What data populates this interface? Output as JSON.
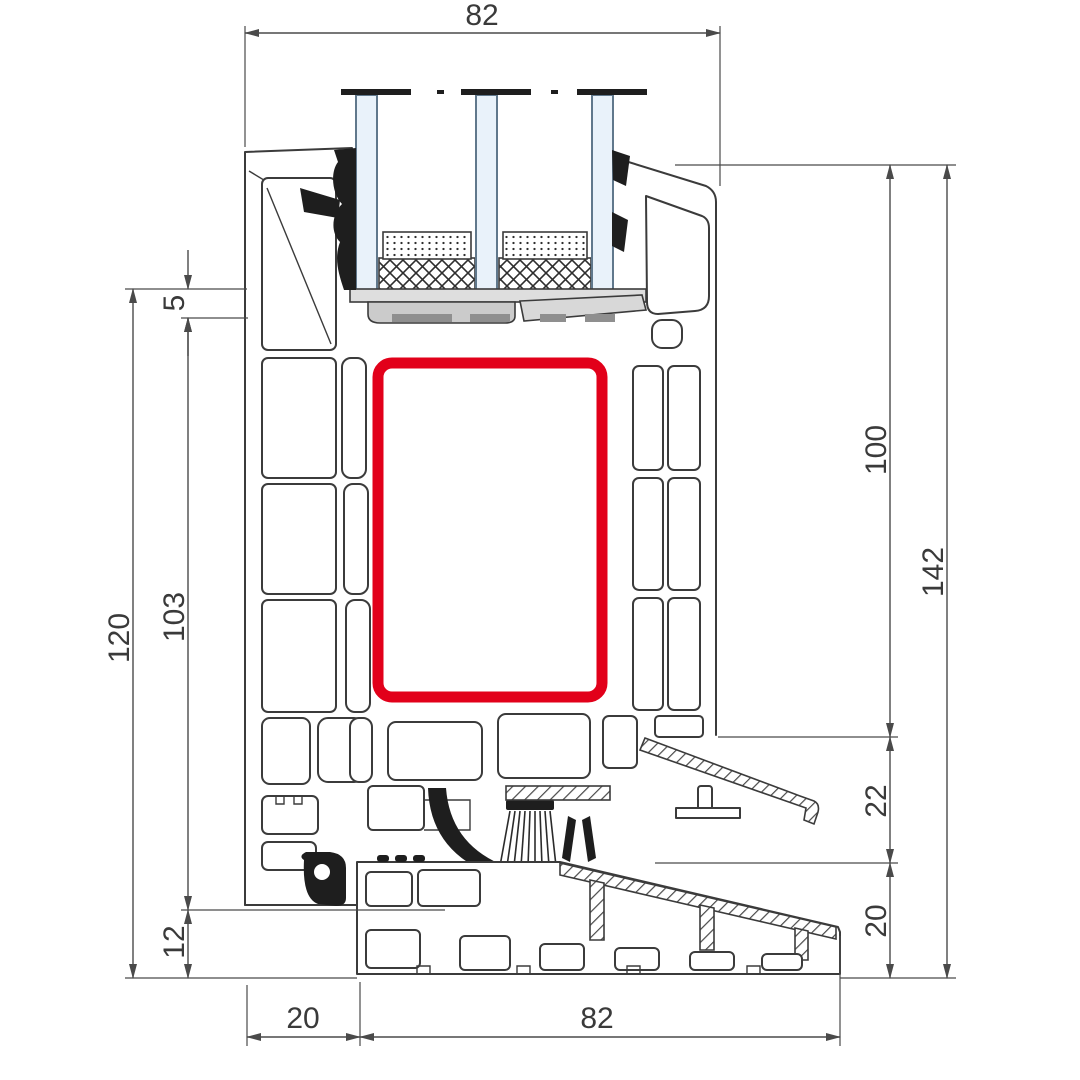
{
  "diagram": {
    "type": "technical-cross-section",
    "subject": "PVC window frame profile with aluminium threshold, vertical section with triple glazing",
    "dimensions": {
      "top_glazing_width": "82",
      "left_overall_height": "120",
      "left_glass_inset": "5",
      "left_frame_height": "103",
      "left_base_height": "12",
      "right_inner_height": "100",
      "right_overall_height": "142",
      "right_step_height": "22",
      "right_base_height": "20",
      "bottom_left_offset": "20",
      "bottom_sill_width": "82"
    },
    "colors": {
      "highlight_red": "#e2001a",
      "glass_blue": "#e9f2fa",
      "profile_line": "#3b3b3b",
      "dimension_line": "#4a4a4a",
      "block_gray": "#d5d5d5",
      "gasket_black": "#1e1e1e"
    }
  }
}
